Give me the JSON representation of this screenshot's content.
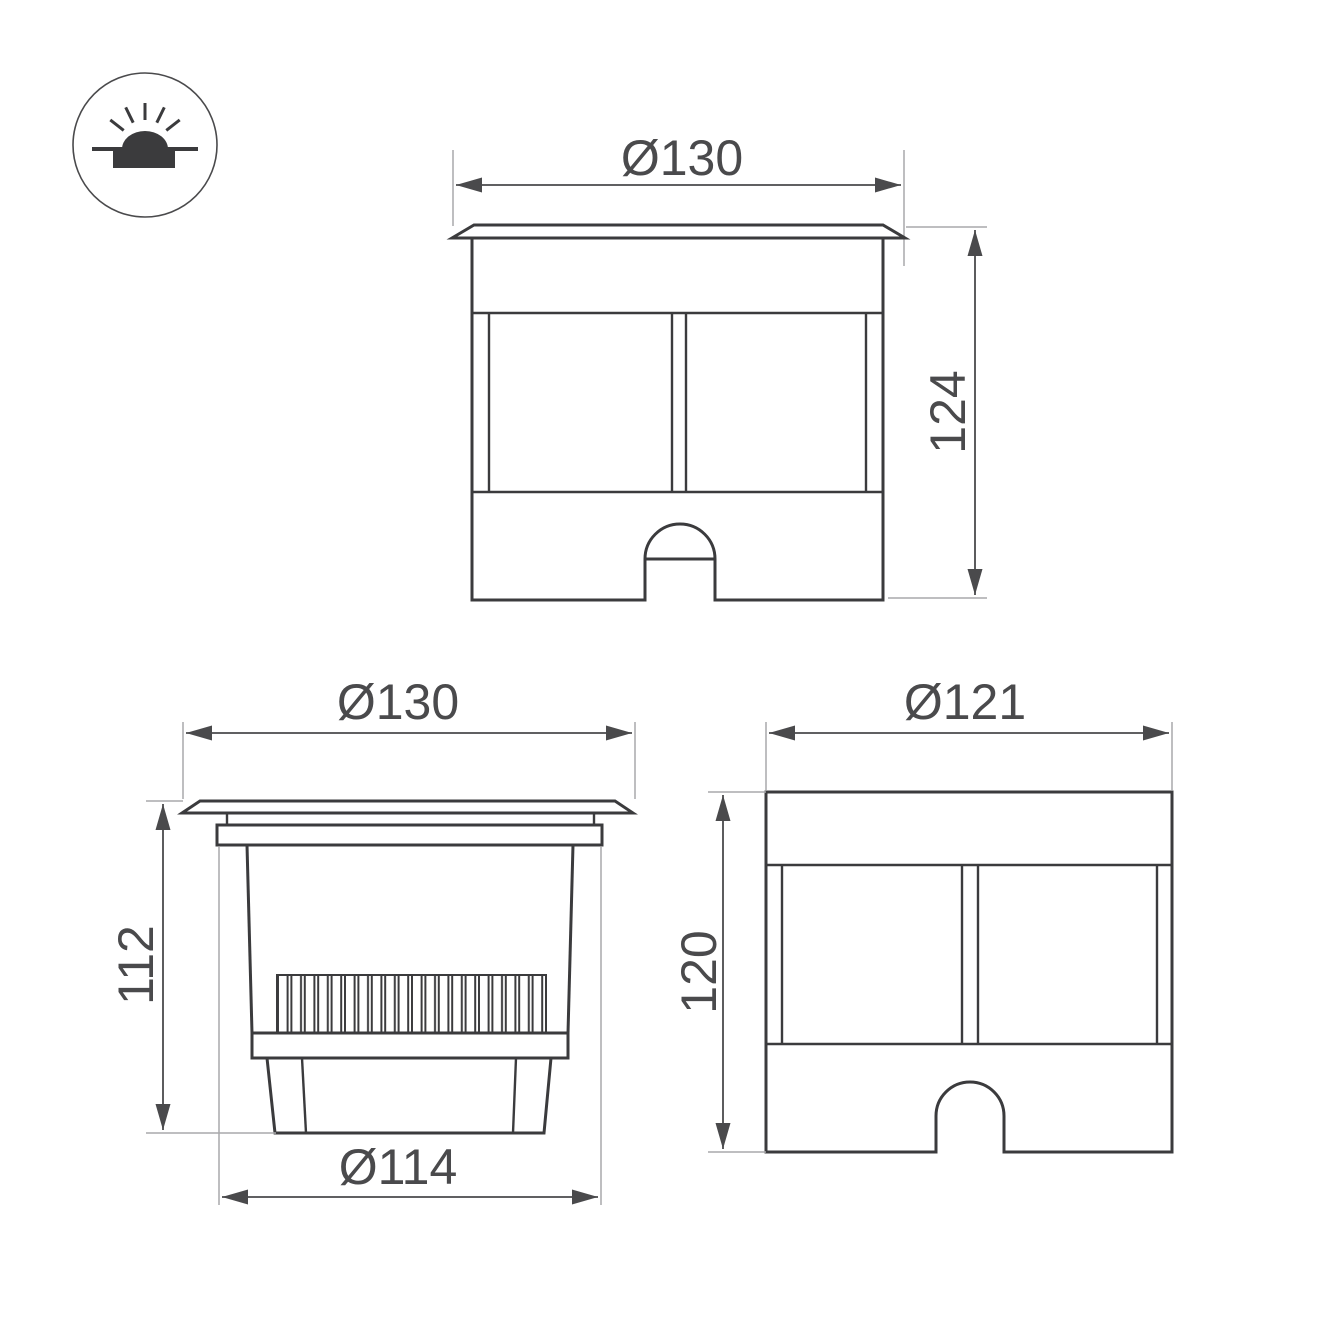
{
  "views": {
    "front": {
      "width_label": "Ø130",
      "height_label": "124"
    },
    "side_section": {
      "width_label": "Ø130",
      "height_label": "112",
      "bottom_width_label": "Ø114"
    },
    "housing_front": {
      "width_label": "Ø121",
      "height_label": "120"
    }
  },
  "colors": {
    "line": "#3b3b3d",
    "dimension": "#4a4a4c",
    "extension": "#a9a9ab",
    "background": "#ffffff"
  }
}
